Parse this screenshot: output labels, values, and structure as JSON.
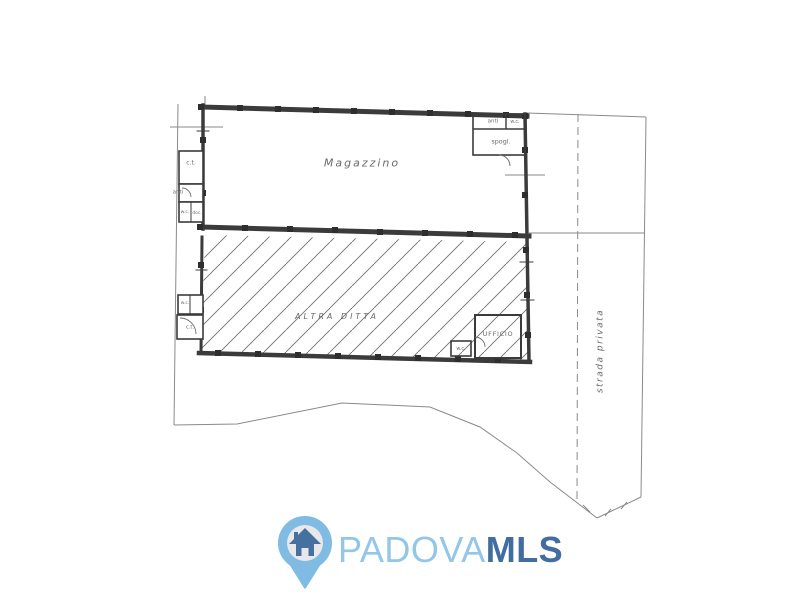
{
  "floor_plan": {
    "rooms": {
      "magazzino": "Magazzino",
      "altra_ditta": "ALTRA DITTA",
      "ufficio": "UFFICIO",
      "spogliatoio": "spogl.",
      "anti_top_right": "anti",
      "wc_top_right": "w.c.",
      "ct_left": "c.t.",
      "anti_left": "anti",
      "wc_left": "w.c.",
      "doccia_left": "doc.",
      "wc_lower_left": "w.c.",
      "ct_lower_left": "c.t.",
      "wc_office": "w.c."
    },
    "annotations": {
      "strada_privata": "strada privata"
    },
    "colors": {
      "walls": "#3b3b3b",
      "thin_lines": "#8a8a8a",
      "hatch": "#6f6f6f",
      "label_text": "#5a5a5a"
    }
  },
  "watermark": {
    "brand": {
      "primary": "PADOVA",
      "secondary": "MLS"
    },
    "icon": "house-pin-icon",
    "colors": {
      "light_blue": "#93c6e7",
      "dark_blue": "#416d9f",
      "pin_fill": "#7fbbe2",
      "pin_inner": "#e8e8ea",
      "house": "#45709f"
    }
  }
}
